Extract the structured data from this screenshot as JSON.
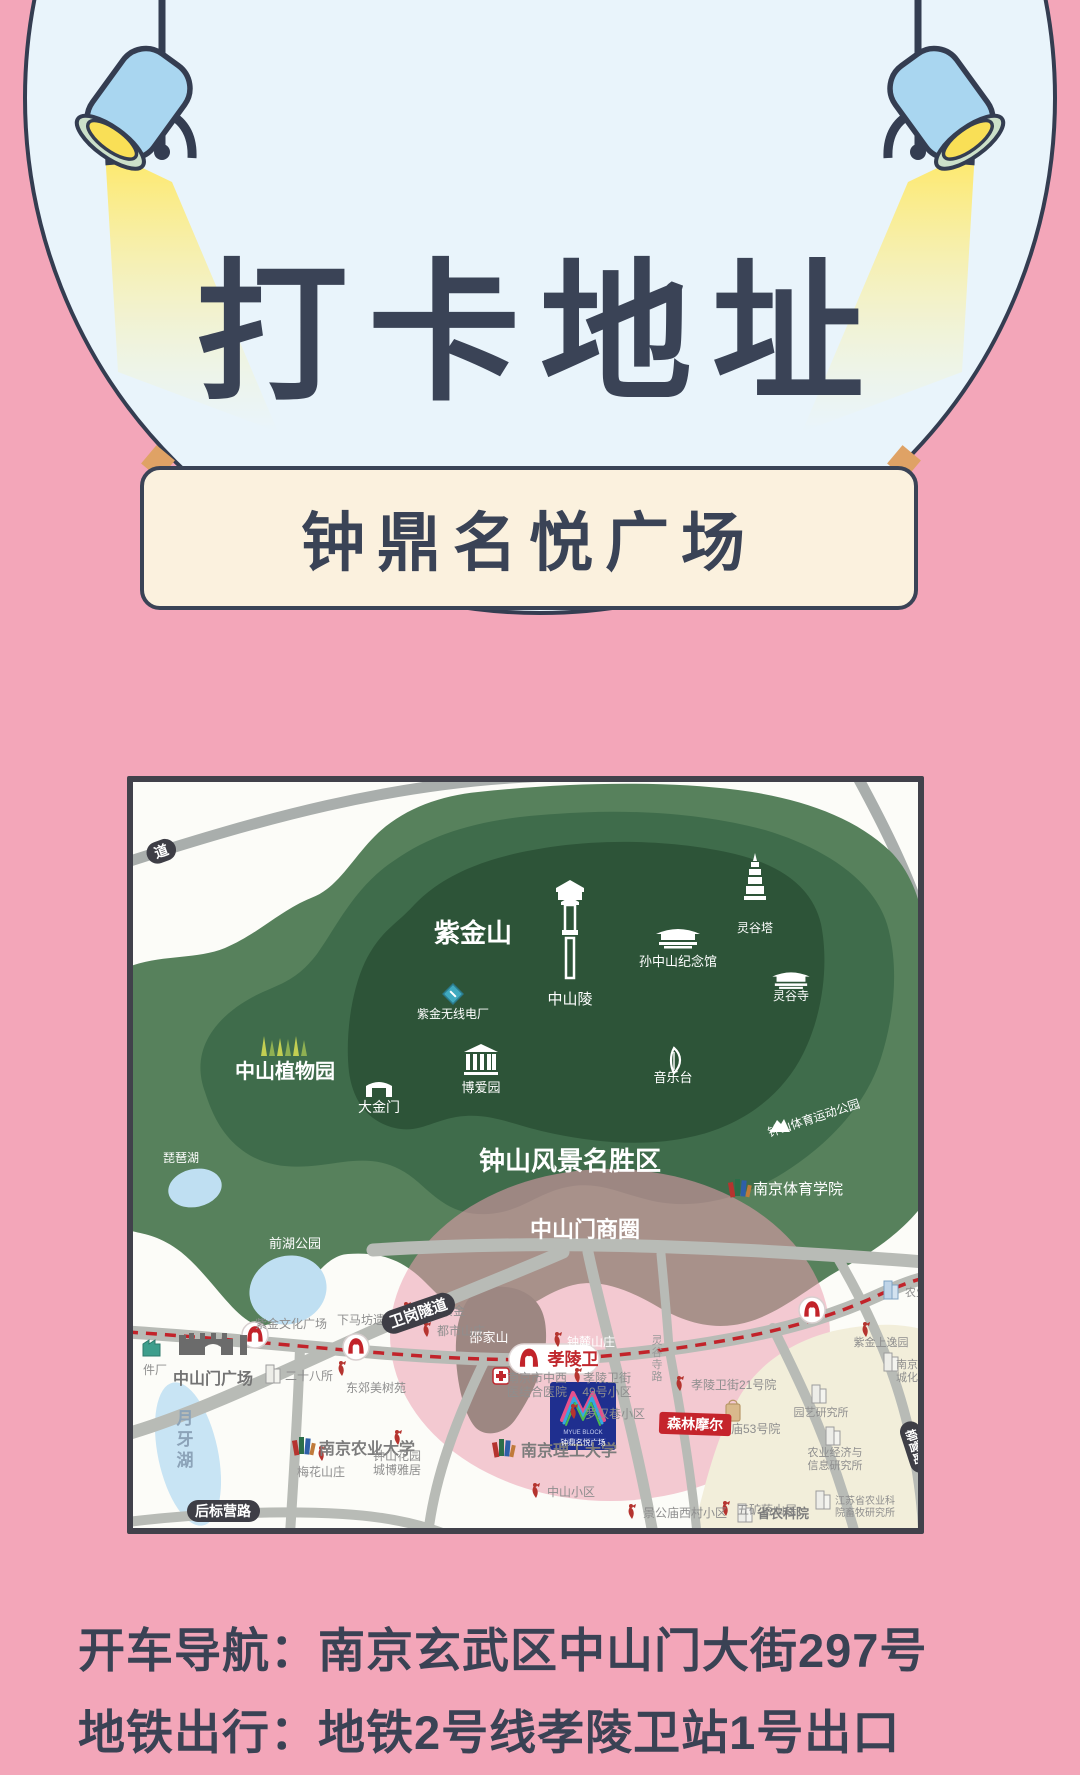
{
  "header": {
    "title": "打卡地址"
  },
  "banner": {
    "title": "钟鼎名悦广场"
  },
  "footer": {
    "line1": "开车导航：南京玄武区中山门大街297号",
    "line2": "地铁出行：地铁2号线孝陵卫站1号出口"
  },
  "colors": {
    "background_pink": "#F3A6B9",
    "circle_fill": "#E9F4FB",
    "outline_navy": "#343D51",
    "banner_cream": "#FBF1DE",
    "lamp_blue": "#A9D6F0",
    "lamp_yellow": "#F9DF56",
    "map_green_outer": "#57815C",
    "map_green_mid": "#3F6C4B",
    "map_green_dark": "#2D5438",
    "map_lake_blue": "#BFDFF2",
    "map_road_gray": "#B8BBB6",
    "metro_red": "#C2232A",
    "highlight_pink": "#EB9FB0",
    "logo_navy": "#1F2F8F",
    "mall_red": "#C5242C"
  },
  "map": {
    "labels": [
      {
        "id": "label-zijinshan",
        "t": "紫金山",
        "x": 340,
        "y": 160,
        "s": 26,
        "c": "#FFFFFF",
        "b": 1
      },
      {
        "id": "label-zhongshanling",
        "t": "中山陵",
        "x": 437,
        "y": 222,
        "s": 15,
        "c": "#FFFFFF"
      },
      {
        "id": "label-sun-memorial",
        "t": "孙中山纪念馆",
        "x": 545,
        "y": 184,
        "s": 13,
        "c": "#FFFFFF"
      },
      {
        "id": "label-linggu-pagoda",
        "t": "灵谷塔",
        "x": 622,
        "y": 150,
        "s": 12,
        "c": "#FFFFFF"
      },
      {
        "id": "label-linggu-temple",
        "t": "灵谷寺",
        "x": 658,
        "y": 218,
        "s": 12,
        "c": "#FFFFFF"
      },
      {
        "id": "label-zijin-radio",
        "t": "紫金无线电厂",
        "x": 320,
        "y": 236,
        "s": 12,
        "c": "#FFFFFF"
      },
      {
        "id": "label-botanical",
        "t": "中山植物园",
        "x": 152,
        "y": 296,
        "s": 20,
        "c": "#FFFFFF",
        "b": 1
      },
      {
        "id": "label-dajinmen",
        "t": "大金门",
        "x": 246,
        "y": 330,
        "s": 14,
        "c": "#FFFFFF"
      },
      {
        "id": "label-boaiyuan",
        "t": "博爱园",
        "x": 348,
        "y": 310,
        "s": 13,
        "c": "#FFFFFF"
      },
      {
        "id": "label-yinyuetai",
        "t": "音乐台",
        "x": 540,
        "y": 300,
        "s": 13,
        "c": "#FFFFFF"
      },
      {
        "id": "label-scenic-area",
        "t": "钟山风景名胜区",
        "x": 437,
        "y": 388,
        "s": 26,
        "c": "#FFFFFF",
        "b": 1
      },
      {
        "id": "label-sports-park",
        "t": "钟山体育运动公园",
        "x": 682,
        "y": 340,
        "s": 12,
        "c": "#FFFFFF",
        "r": -18
      },
      {
        "id": "label-sports-college",
        "t": "南京体育学院",
        "x": 620,
        "y": 412,
        "s": 15,
        "c": "#FFFFFF",
        "a": "start"
      },
      {
        "id": "label-pipa-lake",
        "t": "琵琶湖",
        "x": 48,
        "y": 380,
        "s": 12,
        "c": "#FFFFFF"
      },
      {
        "id": "label-qianhu-park",
        "t": "前湖公园",
        "x": 162,
        "y": 466,
        "s": 13,
        "c": "#FFFFFF"
      },
      {
        "id": "label-shaojiashan",
        "t": "邵家山",
        "x": 356,
        "y": 560,
        "s": 13,
        "c": "#FFFFFF"
      },
      {
        "id": "label-shangquan",
        "t": "中山门商圈",
        "x": 452,
        "y": 455,
        "s": 22,
        "c": "#FFFFFF",
        "b": 1
      },
      {
        "id": "label-zhonglu",
        "t": "钟麓山庄",
        "x": 434,
        "y": 564,
        "s": 12,
        "c": "#FFFFFF",
        "a": "start"
      },
      {
        "id": "label-zsm-square",
        "t": "中山门广场",
        "x": 80,
        "y": 602,
        "s": 16,
        "c": "#737373",
        "b": 1
      },
      {
        "id": "label-zijin-culture",
        "t": "紫金文化广场",
        "x": 158,
        "y": 546,
        "s": 12
      },
      {
        "id": "label-xiamafang",
        "t": "下马坊遗址公园",
        "x": 246,
        "y": 542,
        "s": 12
      },
      {
        "id": "label-junlin",
        "t": "君临紫金",
        "x": 284,
        "y": 533,
        "s": 12,
        "a": "start"
      },
      {
        "id": "label-dushi",
        "t": "都市山庄",
        "x": 304,
        "y": 553,
        "s": 12,
        "a": "start"
      },
      {
        "id": "label-ershiba",
        "t": "二十八所",
        "x": 152,
        "y": 598,
        "s": 12,
        "a": "start"
      },
      {
        "id": "label-dongjiao",
        "t": "东郊美树苑",
        "x": 243,
        "y": 610,
        "s": 12
      },
      {
        "id": "label-nj-agri",
        "t": "南京农业大学",
        "x": 186,
        "y": 672,
        "s": 16,
        "c": "#7C7C7C",
        "b": 1,
        "a": "start"
      },
      {
        "id": "label-njust",
        "t": "南京理工大学",
        "x": 388,
        "y": 674,
        "s": 16,
        "c": "#7C7C7C",
        "b": 1,
        "a": "start"
      },
      {
        "id": "label-hospital",
        "lines": [
          "南京市中西",
          "医结合医院"
        ],
        "x": 404,
        "y": 600,
        "s": 12
      },
      {
        "id": "label-xlw49",
        "lines": [
          "孝陵卫街",
          "49号小区"
        ],
        "x": 474,
        "y": 600,
        "s": 12
      },
      {
        "id": "label-luohan",
        "t": "罗汉巷小区",
        "x": 452,
        "y": 636,
        "s": 12,
        "a": "start"
      },
      {
        "id": "label-xlw21",
        "t": "孝陵卫街21号院",
        "x": 558,
        "y": 607,
        "s": 12,
        "a": "start"
      },
      {
        "id": "label-jgm53",
        "t": "景公庙53号院",
        "x": 574,
        "y": 651,
        "s": 12,
        "a": "start"
      },
      {
        "id": "label-wukuang",
        "t": "五矿蒋山居",
        "x": 604,
        "y": 732,
        "s": 12,
        "a": "start"
      },
      {
        "id": "label-zs-xiaoqu",
        "t": "中山小区",
        "x": 414,
        "y": 714,
        "s": 12,
        "a": "start"
      },
      {
        "id": "label-jgm-west",
        "t": "景公庙西村小区",
        "x": 510,
        "y": 735,
        "s": 12,
        "a": "start"
      },
      {
        "id": "label-nongkeyuan",
        "t": "省农科院",
        "x": 624,
        "y": 736,
        "s": 13,
        "c": "#7C7C7C",
        "b": 1,
        "a": "start"
      },
      {
        "id": "label-js-academy",
        "lines": [
          "江苏省农业科",
          "院畜牧研究所"
        ],
        "x": 702,
        "y": 722,
        "s": 10,
        "a": "start"
      },
      {
        "id": "label-agri-econ",
        "lines": [
          "农业经济与",
          "信息研究所"
        ],
        "x": 702,
        "y": 674,
        "s": 11
      },
      {
        "id": "label-yuanyi",
        "t": "园艺研究所",
        "x": 688,
        "y": 634,
        "s": 11
      },
      {
        "id": "label-shangyiyuan",
        "t": "紫金上逸园",
        "x": 748,
        "y": 564,
        "s": 11
      },
      {
        "id": "label-nj-chenghua",
        "lines": [
          "南京",
          "城化"
        ],
        "x": 774,
        "y": 586,
        "s": 11
      },
      {
        "id": "label-nongye-cut",
        "t": "农业",
        "x": 772,
        "y": 514,
        "s": 11,
        "a": "start"
      },
      {
        "id": "label-meihua",
        "t": "梅花山庄",
        "x": 188,
        "y": 694,
        "s": 12
      },
      {
        "id": "label-zs-garden",
        "lines": [
          "钟山花园",
          "城博雅居"
        ],
        "x": 264,
        "y": 678,
        "s": 12
      },
      {
        "id": "label-yueyahu",
        "lines": [
          "月",
          "牙",
          "湖"
        ],
        "x": 52,
        "y": 642,
        "s": 17,
        "c": "#8CA3B8",
        "b": 1,
        "lh": 21
      },
      {
        "id": "label-linggusi-road",
        "lines": [
          "灵",
          "谷",
          "寺",
          "路"
        ],
        "x": 524,
        "y": 562,
        "s": 11,
        "c": "#9A9A9A",
        "lh": 12
      },
      {
        "id": "label-jianchang",
        "t": "件厂",
        "x": 10,
        "y": 592,
        "s": 12,
        "a": "start"
      },
      {
        "id": "pill-dao",
        "t": "道",
        "x": 30,
        "y": 74,
        "s": 14,
        "pill": 1,
        "r": -20
      },
      {
        "id": "pill-weigang",
        "t": "卫岗隧道",
        "x": 287,
        "y": 536,
        "s": 15,
        "pill": 1,
        "r": -19
      },
      {
        "id": "pill-houbiaoying",
        "t": "后标营路",
        "x": 90,
        "y": 734,
        "s": 14,
        "pill": 1
      },
      {
        "id": "pill-liuying",
        "t": "柳营路",
        "x": 778,
        "y": 666,
        "s": 12,
        "pill": 1,
        "r": 72
      },
      {
        "id": "label-xiaolingwei",
        "t": "孝陵卫",
        "x": 440,
        "y": 583,
        "s": 17,
        "c": "#C0272D",
        "b": 1
      },
      {
        "id": "label-senlin-moer",
        "t": "森林摩尔",
        "x": 562,
        "y": 647,
        "s": 14,
        "pill": 1,
        "pc": "#C5242C",
        "prx": 3,
        "r": 2
      },
      {
        "id": "label-myue-en",
        "t": "MYUE BLOCK",
        "x": 450,
        "y": 652,
        "s": 6,
        "c": "#C3CCEE"
      },
      {
        "id": "label-myue-cn",
        "t": "钟鼎名悦广场",
        "x": 450,
        "y": 663,
        "s": 7.5,
        "c": "#FFFFFF"
      }
    ]
  }
}
